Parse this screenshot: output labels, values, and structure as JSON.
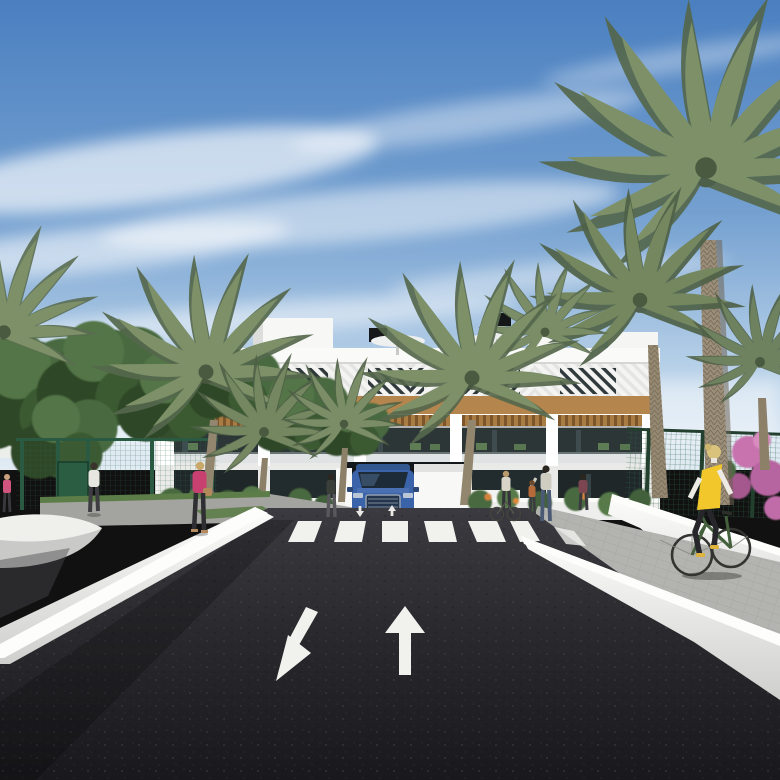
{
  "scene": {
    "type": "architectural-3d-render",
    "description": "Photorealistic rendering of a modern white Mediterranean apartment complex with wood-accent pergolas, tall palm trees, garden shrubs, pedestrians on side paths, a woman cycling on a lane at right, a blue SUV exiting a central garage ramp, and a dark asphalt road in the foreground with painted two-way direction arrows and a zebra crosswalk",
    "time_of_day": "daytime, blue sky with wispy clouds"
  },
  "colors": {
    "sky_top": "#4a7fc0",
    "sky_mid": "#74a0d0",
    "sky_haze": "#b6d0e8",
    "sky_horizon": "#e2ecf4",
    "cloud_white": "#ffffff",
    "building_white": "#f3f3f1",
    "building_shadow": "#d8dad9",
    "window_dark": "#2c3637",
    "glass_ground": "#1f2729",
    "wood_accent": "#b5854e",
    "palm_green": "#7d9068",
    "palm_dark": "#55684c",
    "tree_green": "#42603a",
    "grass_green": "#5d7d48",
    "fence_green": "#2a5a41",
    "mesh_green": "#3f7a55",
    "asphalt": "#27272b",
    "road_marking": "#f1f1ee",
    "path_gray": "#b0b0ac",
    "sidewalk_gray": "#a3a39f",
    "wall_white": "#efefec",
    "car_blue": "#3b63a9",
    "vest_yellow": "#f2c72c",
    "jacket_pink": "#c8406f",
    "flower_pink": "#c873ae",
    "flower_orange": "#d4823c"
  },
  "objects": {
    "building": {
      "style": "modern white apartment block",
      "levels": "ground floor terraces, middle balcony floor, top floor with white diagonal louvers, roof terraces with parasols",
      "accents": "horizontal wood cladding band and wood pergolas over balconies"
    },
    "road": {
      "surface": "dark asphalt",
      "markings": [
        "zebra crosswalk",
        "up arrow (lane away from viewer)",
        "down-left arrow (lane toward viewer)",
        "two small lane arrows near crosswalk"
      ]
    },
    "vehicle": {
      "type": "SUV",
      "color": "blue",
      "position": "front-facing at central garage ramp"
    },
    "people": {
      "left_sidewalk": [
        "man in white shirt walking",
        "woman in pink jacket with handbag"
      ],
      "center": [
        "woman standing near planter"
      ],
      "right_walkway": [
        "woman with parked bicycle",
        "adult with child",
        "person in dark top"
      ],
      "cyclist": "woman in yellow vest on dark green bicycle riding the right-side lane"
    },
    "vegetation": {
      "palm_trees": 8,
      "left": "dense green trees behind a dark green sports fence",
      "right": "green mesh fence with pink flowering shrubs",
      "garden": "low shrubs with orange and pink flowers along the building"
    }
  }
}
